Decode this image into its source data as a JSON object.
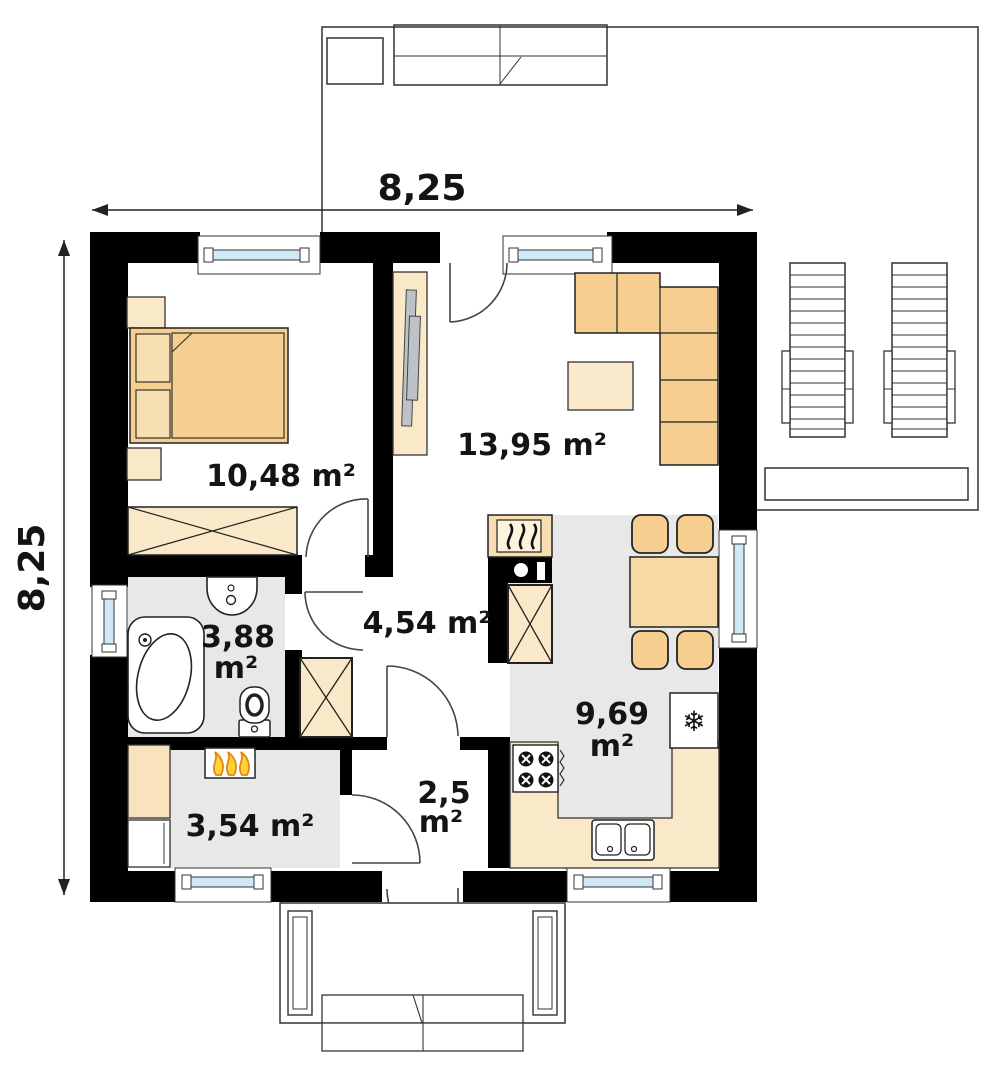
{
  "plan": {
    "title": "single-storey house floor plan",
    "dimensions": {
      "top": "8,25",
      "left": "8,25"
    },
    "rooms": {
      "bedroom": {
        "area": "10,48 m²"
      },
      "living_room": {
        "area": "13,95 m²"
      },
      "hall": {
        "area": "4,54 m²"
      },
      "bathroom": {
        "area_value": "3,88",
        "area_unit": "m²"
      },
      "kitchen": {
        "area_value": "9,69",
        "area_unit": "m²"
      },
      "utility_room": {
        "area": "3,54 m²"
      },
      "vestibule": {
        "area_value": "2,5",
        "area_unit": "m²"
      }
    },
    "symbols": {
      "fridge_snowflake": "❄"
    },
    "colors": {
      "wall": "#000000",
      "floor_gray": "#E8E8E8",
      "furniture_light": "#FAE9C8",
      "furniture_accent": "#F6CE8F",
      "window_glass": "#CFE9F6",
      "flame_orange": "#E8860C",
      "flame_yellow": "#FFD23E",
      "tv_gray": "#BCC2C8"
    }
  }
}
